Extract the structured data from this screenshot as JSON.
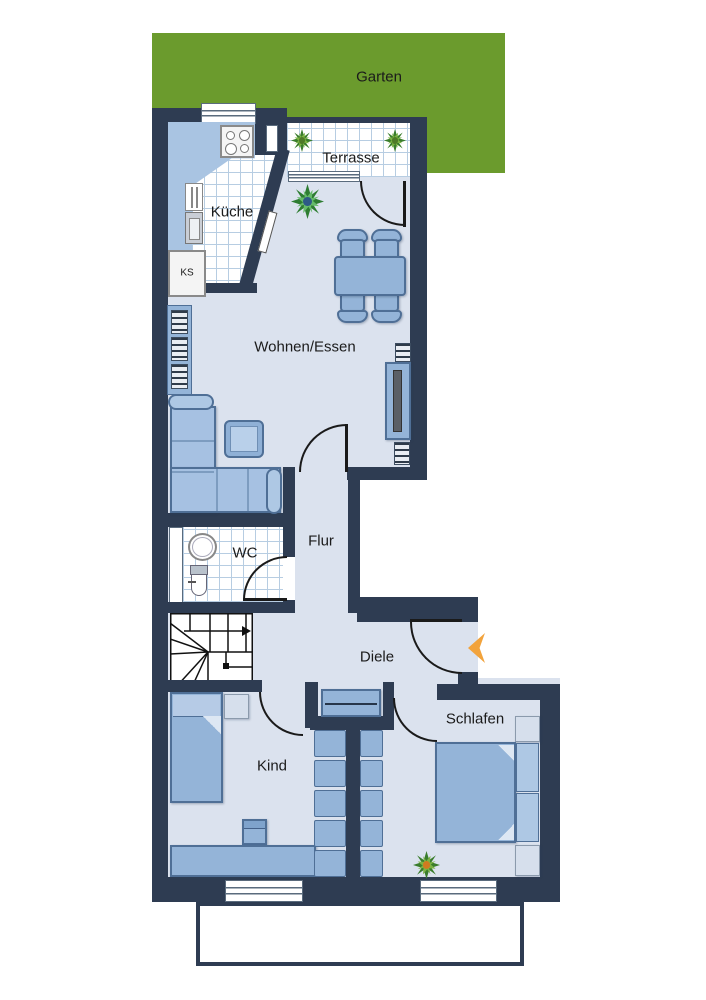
{
  "labels": {
    "garden": "Garten",
    "terrace": "Terrasse",
    "kitchen": "Küche",
    "fridge": "KS",
    "living": "Wohnen/Essen",
    "hall": "Flur",
    "wc": "WC",
    "vestibule": "Diele",
    "child": "Kind",
    "bedroom": "Schlafen"
  },
  "colors": {
    "wall": "#2e3c52",
    "floor": "#dbe2ee",
    "garden": "#6b9b2d",
    "furniture": "#94b4d8",
    "arrow": "#f2a33c"
  }
}
